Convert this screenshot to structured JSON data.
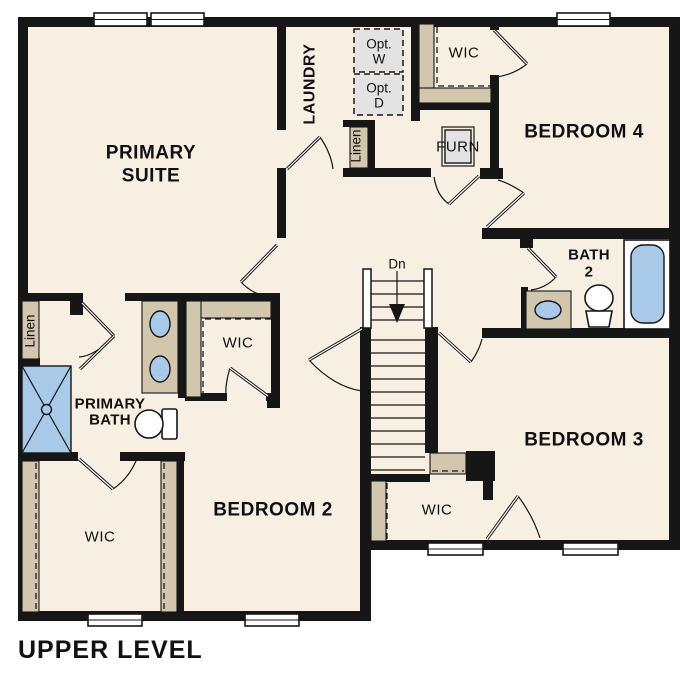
{
  "title": "UPPER LEVEL",
  "colors": {
    "floor": "#f6efe2",
    "wall": "#161616",
    "closet_tan": "#d2c6ae",
    "fixture_blue": "#a9c9e9",
    "appliance_gray": "#e3e3e3",
    "background": "#ffffff"
  },
  "plan": {
    "rooms": {
      "primary_suite": [
        "PRIMARY",
        "SUITE"
      ],
      "laundry": "LAUNDRY",
      "bedroom_4": "BEDROOM 4",
      "bath_2": [
        "BATH",
        "2"
      ],
      "primary_bath": [
        "PRIMARY",
        "BATH"
      ],
      "bedroom_2": "BEDROOM 2",
      "bedroom_3": "BEDROOM 3"
    },
    "closets": {
      "wic_bedroom4": "WIC",
      "wic_primary": "WIC",
      "wic_bedroom2": "WIC",
      "wic_bedroom3": "WIC",
      "linen_hall": "Linen",
      "linen_bath": "Linen"
    },
    "fixtures": {
      "furnace": "FURN",
      "opt_washer": [
        "Opt.",
        "W"
      ],
      "opt_dryer": [
        "Opt.",
        "D"
      ]
    },
    "stairs": {
      "direction": "Dn"
    }
  }
}
